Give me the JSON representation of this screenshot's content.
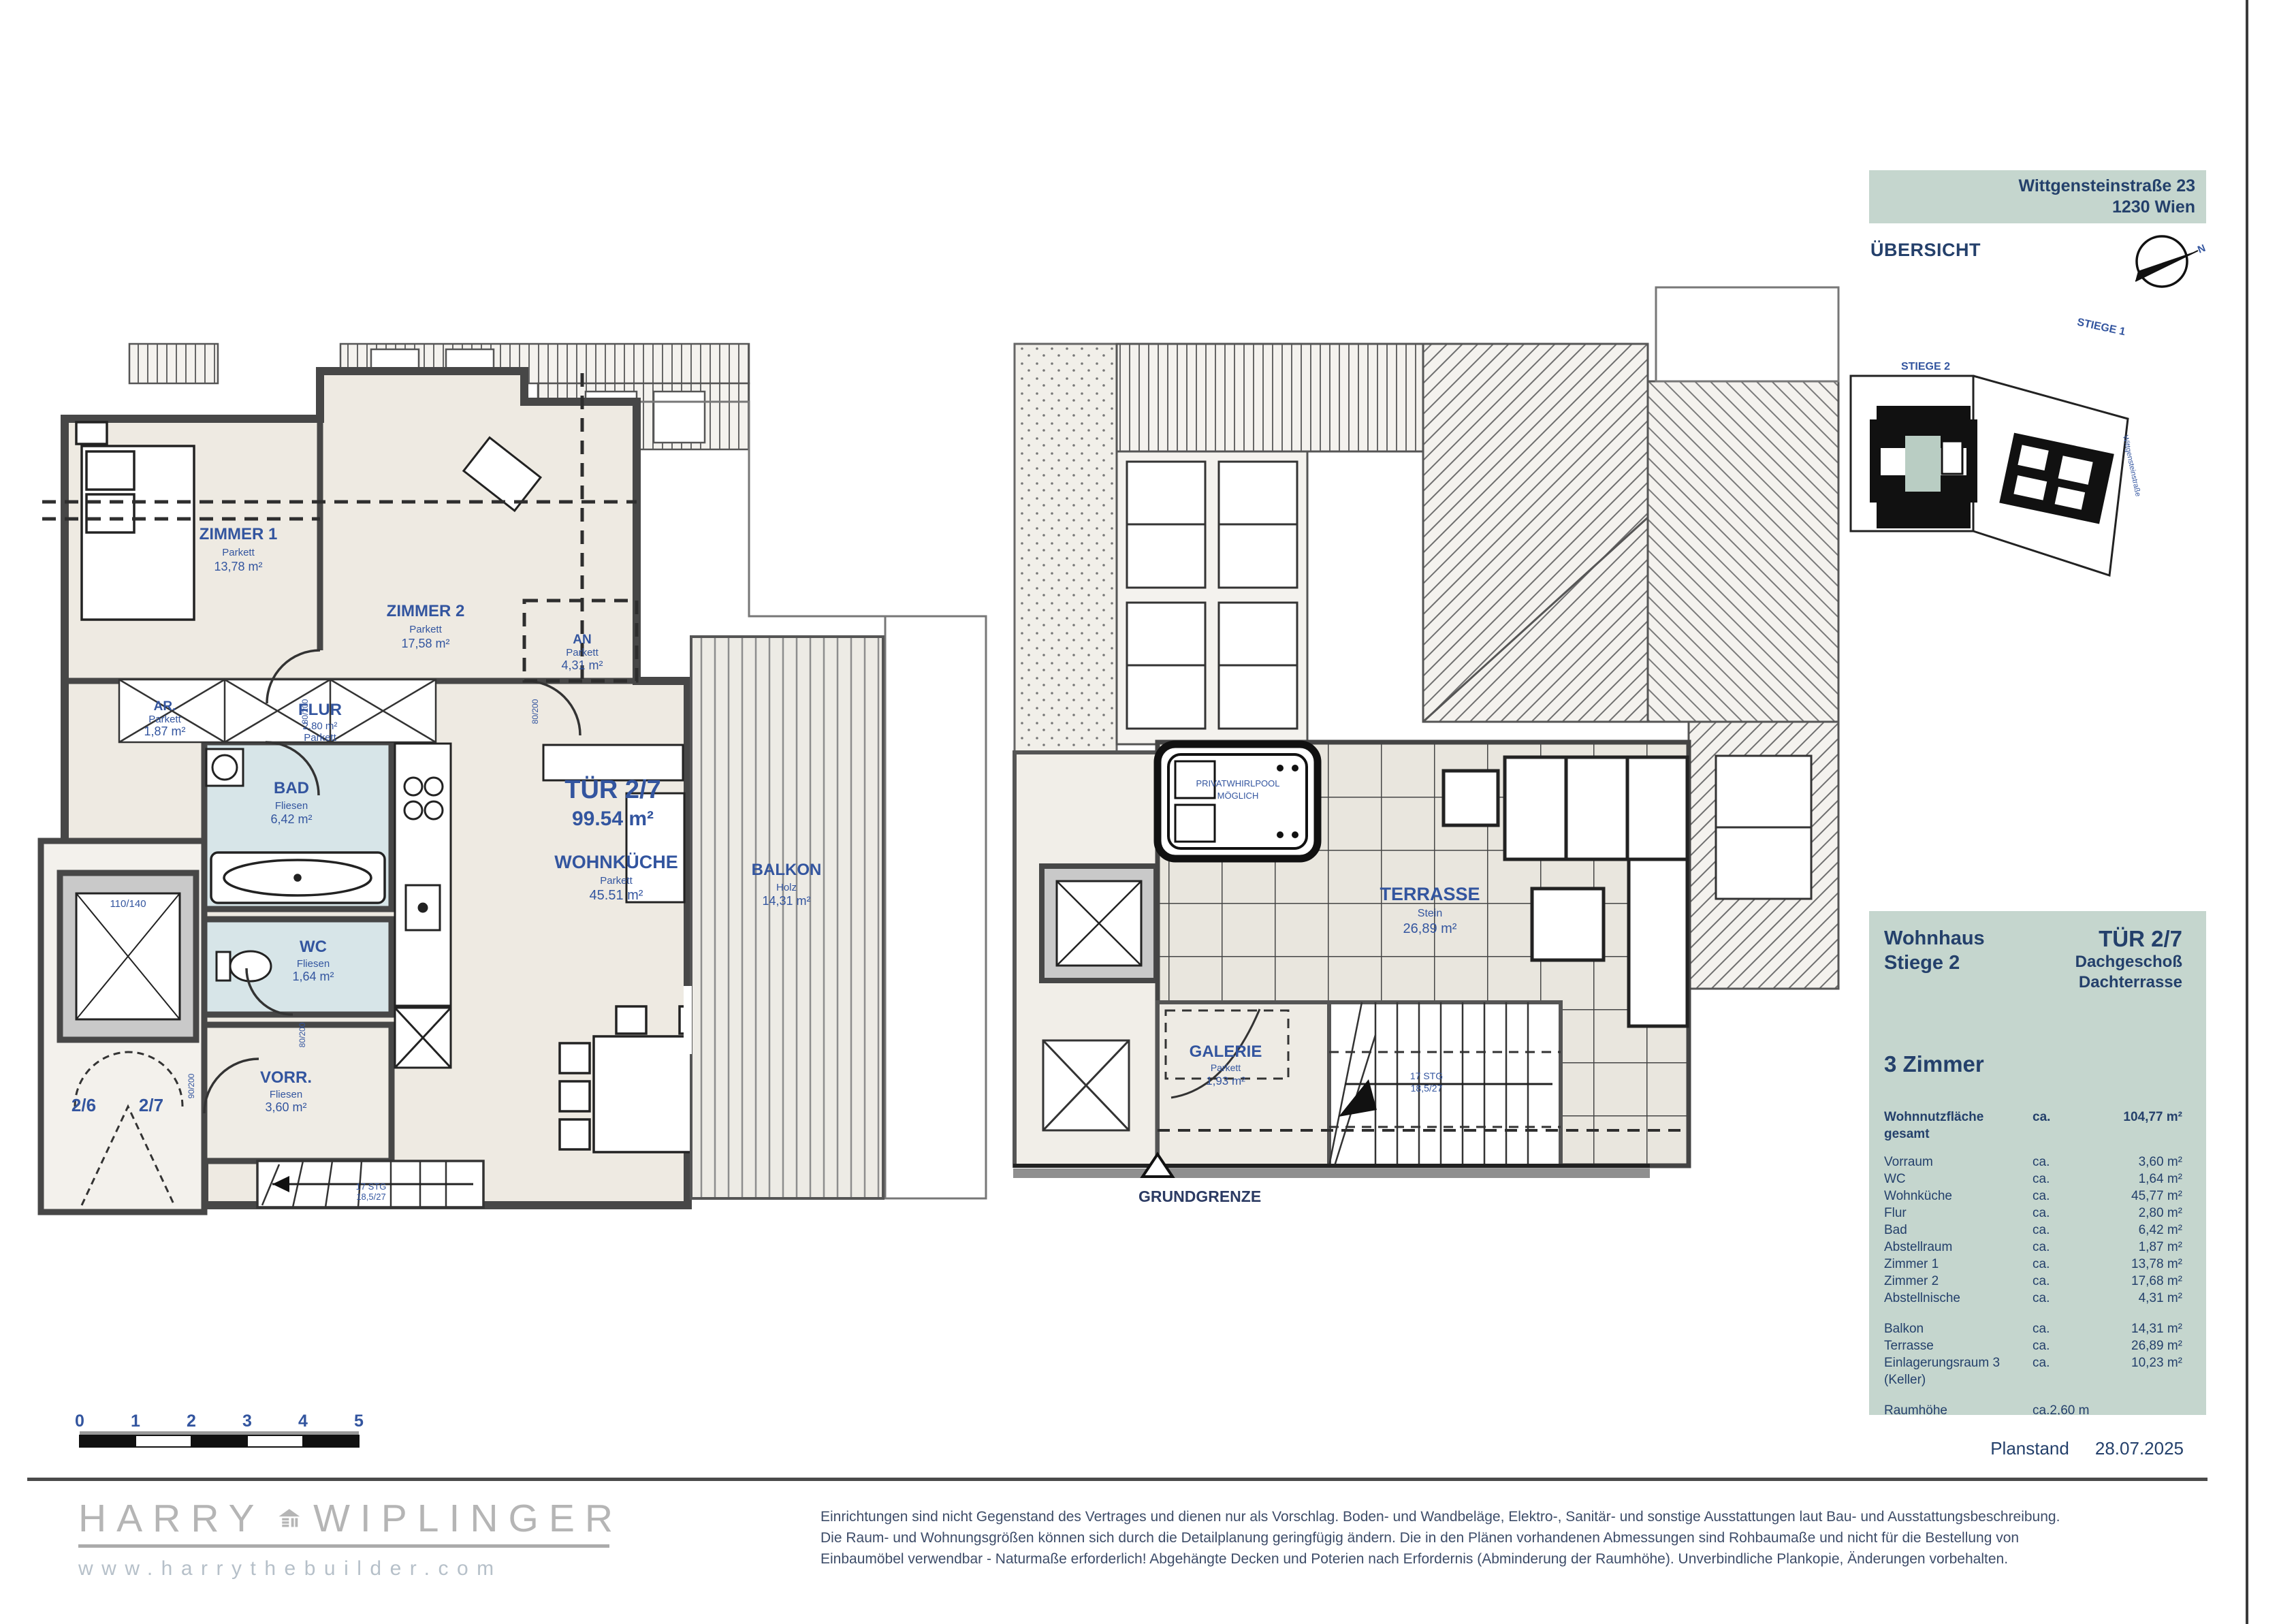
{
  "header": {
    "address1": "Wittgensteinstraße 23",
    "address2": "1230 Wien",
    "overview": "ÜBERSICHT",
    "stiege2": "STIEGE 2",
    "stiege1": "STIEGE 1",
    "street": "Wittgensteinstraße",
    "north": "N"
  },
  "panel": {
    "building": "Wohnhaus",
    "stair": "Stiege 2",
    "unit": "TÜR 2/7",
    "floor1": "Dachgeschoß",
    "floor2": "Dachterrasse",
    "rooms_title": "3 Zimmer",
    "total_label": "Wohnnutzfläche gesamt",
    "total_ca": "ca.",
    "total_value": "104,77 m²",
    "rows": [
      {
        "label": "Vorraum",
        "ca": "ca.",
        "value": "3,60 m²"
      },
      {
        "label": "WC",
        "ca": "ca.",
        "value": "1,64 m²"
      },
      {
        "label": "Wohnküche",
        "ca": "ca.",
        "value": "45,77 m²"
      },
      {
        "label": "Flur",
        "ca": "ca.",
        "value": "2,80 m²"
      },
      {
        "label": "Bad",
        "ca": "ca.",
        "value": "6,42 m²"
      },
      {
        "label": "Abstellraum",
        "ca": "ca.",
        "value": "1,87 m²"
      },
      {
        "label": "Zimmer 1",
        "ca": "ca.",
        "value": "13,78 m²"
      },
      {
        "label": "Zimmer 2",
        "ca": "ca.",
        "value": "17,68 m²"
      },
      {
        "label": "Abstellnische",
        "ca": "ca.",
        "value": "4,31 m²"
      }
    ],
    "rows2": [
      {
        "label": "Balkon",
        "ca": "ca.",
        "value": "14,31 m²"
      },
      {
        "label": "Terrasse",
        "ca": "ca.",
        "value": "26,89 m²"
      },
      {
        "label": "Einlagerungsraum 3 (Keller)",
        "ca": "ca.",
        "value": "10,23 m²"
      }
    ],
    "height_label": "Raumhöhe",
    "height_value": "ca.2,60 m"
  },
  "planstand": {
    "label": "Planstand",
    "date": "28.07.2025"
  },
  "scalebar": {
    "t0": "0",
    "t1": "1",
    "t2": "2",
    "t3": "3",
    "t4": "4",
    "t5": "5"
  },
  "plan_left": {
    "zimmer1": {
      "l1": "ZIMMER 1",
      "l2": "Parkett",
      "l3": "13,78 m²"
    },
    "zimmer2": {
      "l1": "ZIMMER 2",
      "l2": "Parkett",
      "l3": "17,58 m²"
    },
    "an": {
      "l1": "AN",
      "l2": "Parkett",
      "l3": "4,31 m²"
    },
    "ar": {
      "l1": "AR.",
      "l2": "Parkett",
      "l3": "1,87 m²"
    },
    "flur": {
      "l1": "FLUR",
      "l2": "2,80 m²",
      "l3": "Parkett"
    },
    "bad": {
      "l1": "BAD",
      "l2": "Fliesen",
      "l3": "6,42 m²"
    },
    "wc": {
      "l1": "WC",
      "l2": "Fliesen",
      "l3": "1,64 m²"
    },
    "vorr": {
      "l1": "VORR.",
      "l2": "Fliesen",
      "l3": "3,60 m²"
    },
    "tuer": {
      "l1": "TÜR 2/7",
      "l2": "99.54 m²"
    },
    "wohnkueche": {
      "l1": "WOHNKÜCHE",
      "l2": "Parkett",
      "l3": "45.51 m²"
    },
    "balkon": {
      "l1": "BALKON",
      "l2": "Holz",
      "l3": "14,31 m²"
    },
    "door_left": "2/6",
    "door_right": "2/7",
    "lift": "110/140",
    "stairs1": "17 STG",
    "stairs2": "18,5/27",
    "tag80": "80/200",
    "tag90": "90/200"
  },
  "plan_right": {
    "terrasse": {
      "l1": "TERRASSE",
      "l2": "Stein",
      "l3": "26,89 m²"
    },
    "galerie": {
      "l1": "GALERIE",
      "l2": "Parkett",
      "l3": "1,93 m²"
    },
    "whirlpool1": "PRIVATWHIRLPOOL",
    "whirlpool2": "MÖGLICH",
    "grundgrenze": "GRUNDGRENZE",
    "stairs1": "17 STG",
    "stairs2": "18,5/27"
  },
  "footer": {
    "logo_left": "HARRY",
    "logo_right": "WIPLINGER",
    "url": "www.harrythebuilder.com",
    "disclaimer1": "Einrichtungen sind nicht Gegenstand des Vertrages und dienen nur als Vorschlag. Boden- und Wandbeläge, Elektro-, Sanitär- und sonstige Ausstattungen laut Bau- und Ausstattungsbeschreibung.",
    "disclaimer2": "Die Raum- und Wohnungsgrößen können sich durch die Detailplanung geringfügig ändern. Die in den Plänen vorhandenen Abmessungen sind Rohbaumaße und nicht für die Bestellung von",
    "disclaimer3": "Einbaumöbel verwendbar - Naturmaße erforderlich! Abgehängte Decken und Poterien nach Erfordernis (Abminderung der Raumhöhe). Unverbindliche Plankopie, Änderungen vorbehalten."
  }
}
